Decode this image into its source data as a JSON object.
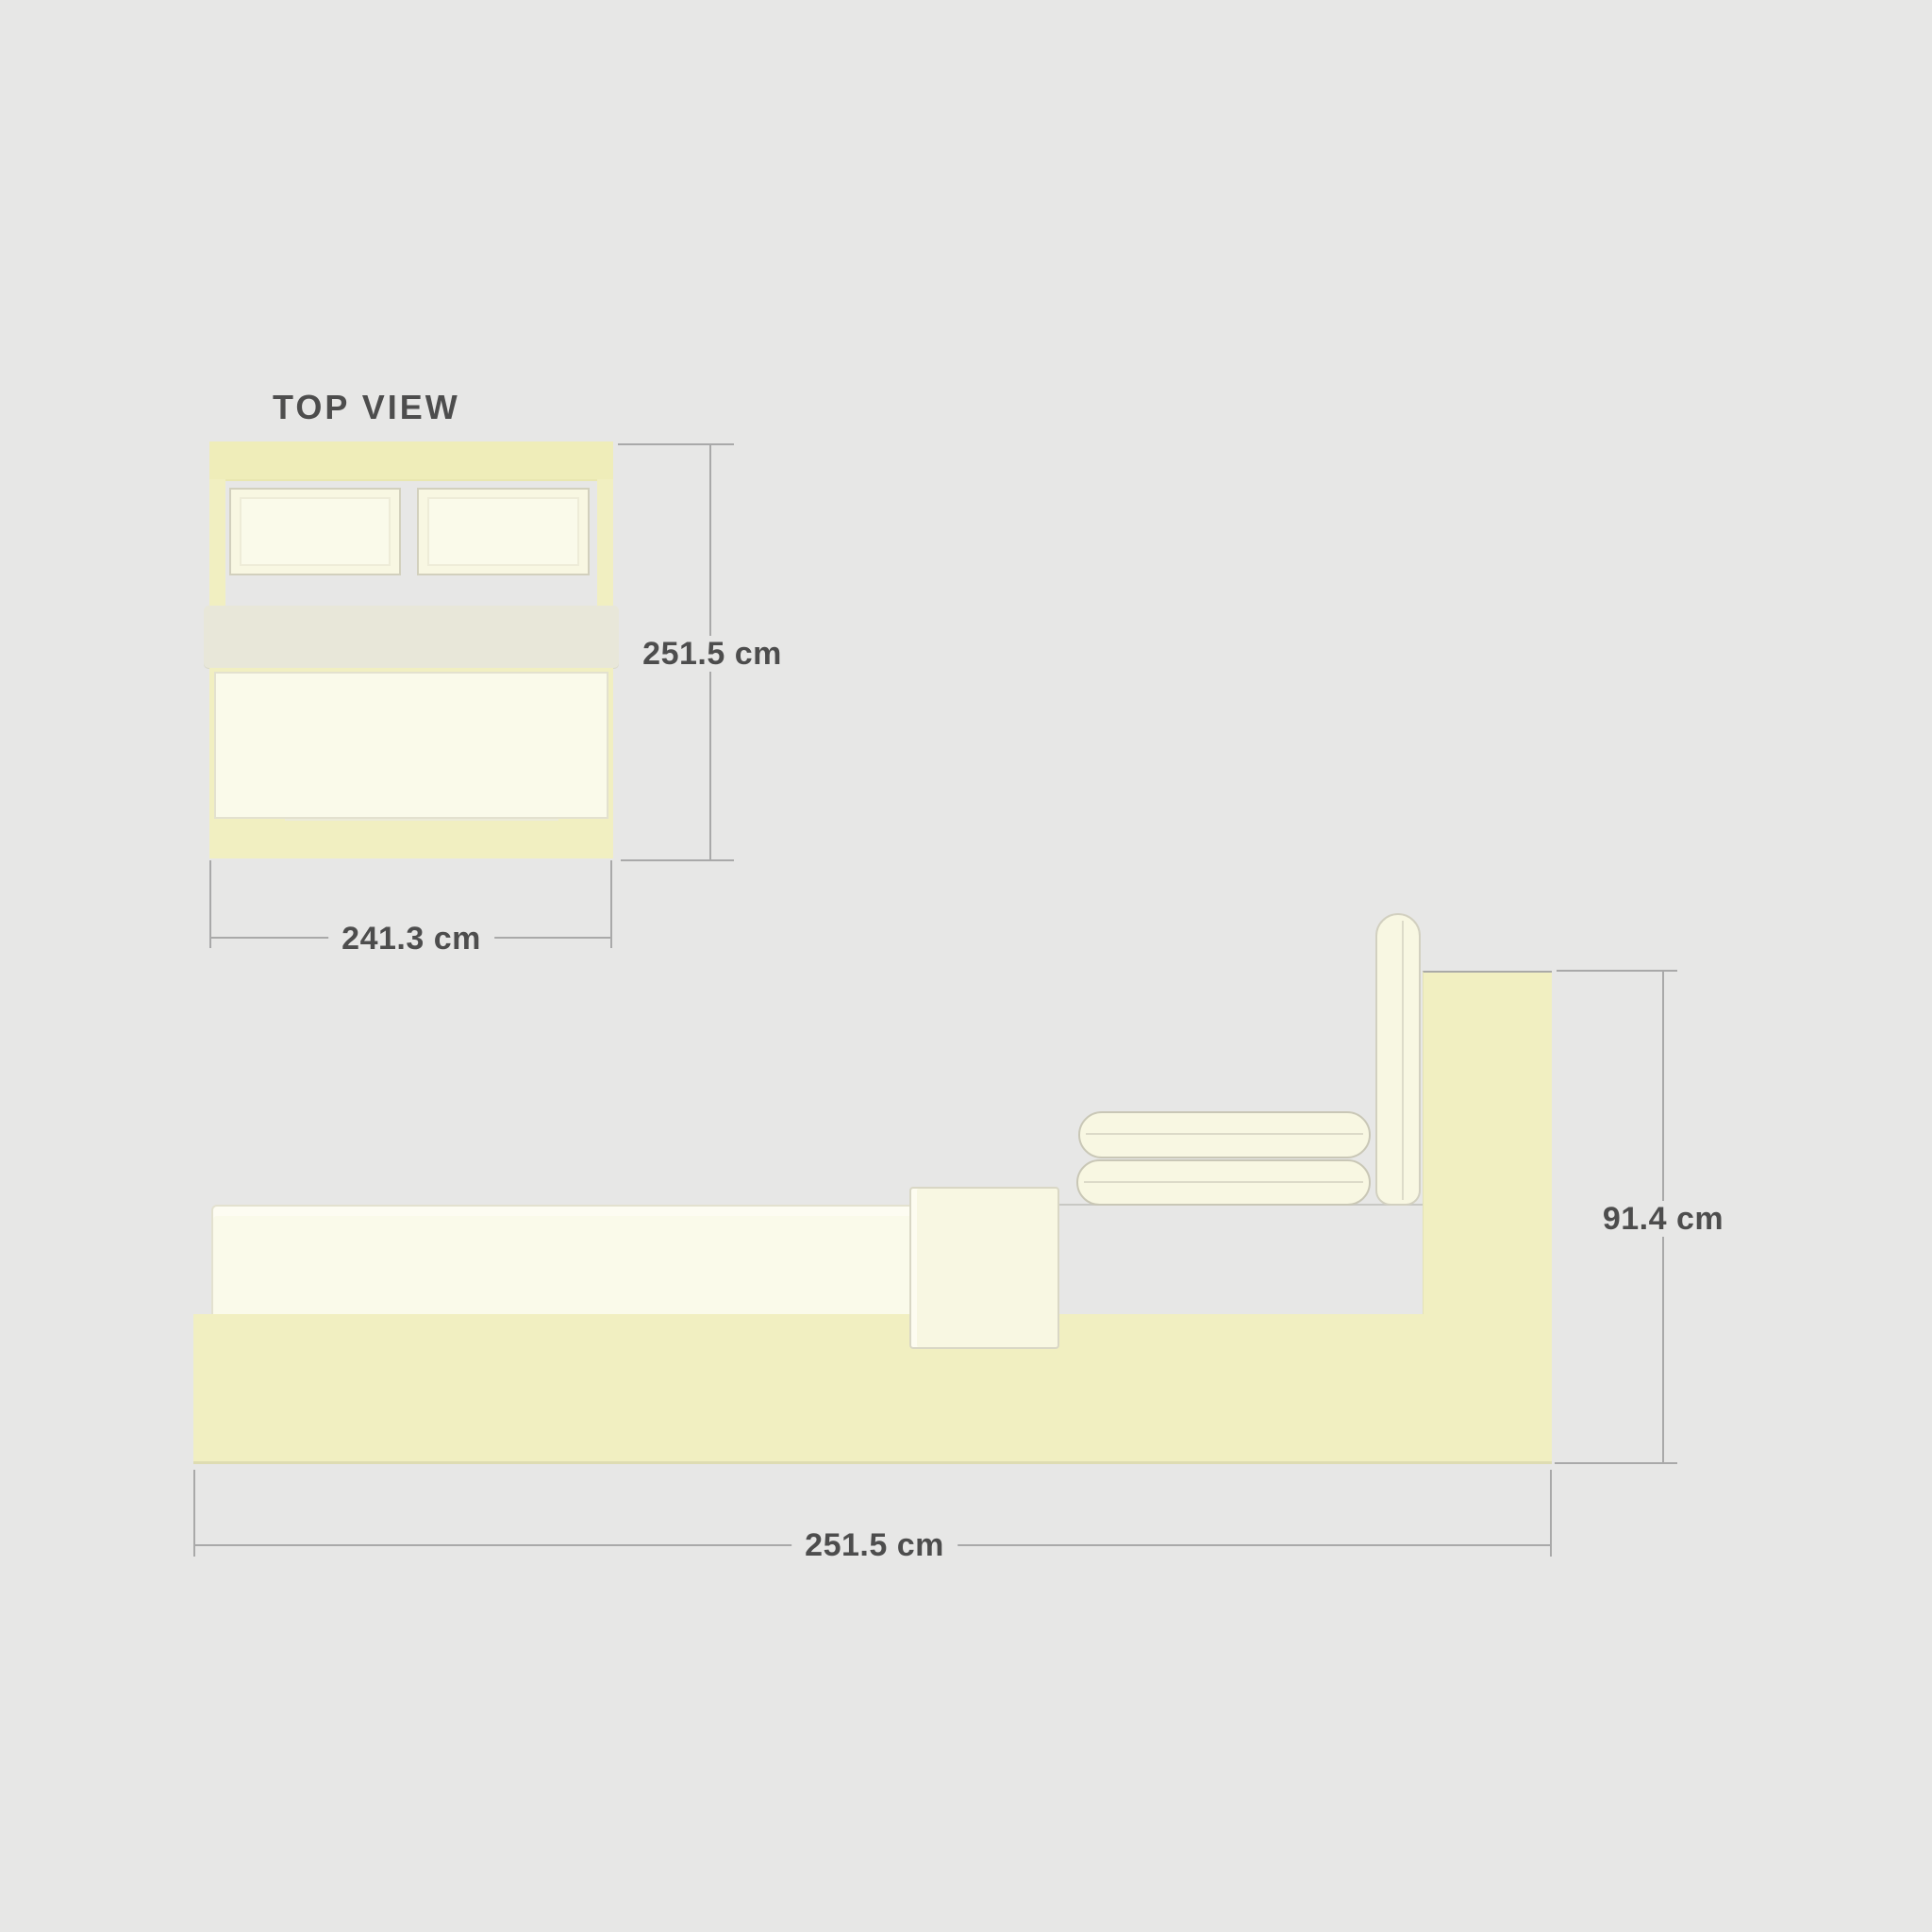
{
  "palette": {
    "bg": "#e7e7e6",
    "yellow": "#f1efc1",
    "yellow_deep": "#efedb9",
    "cream": "#fafaea",
    "cream_soft": "#f8f7e2",
    "band_gray": "#e8e7d9",
    "outline": "#d2d0bd",
    "outline_soft": "#e3e1cf",
    "dim_line": "#a9a9a9",
    "text": "#4d4d4d"
  },
  "top_view": {
    "title": "TOP VIEW",
    "height_label": "251.5 cm",
    "width_label": "241.3 cm"
  },
  "side_view": {
    "height_label": "91.4 cm",
    "length_label": "251.5 cm"
  }
}
